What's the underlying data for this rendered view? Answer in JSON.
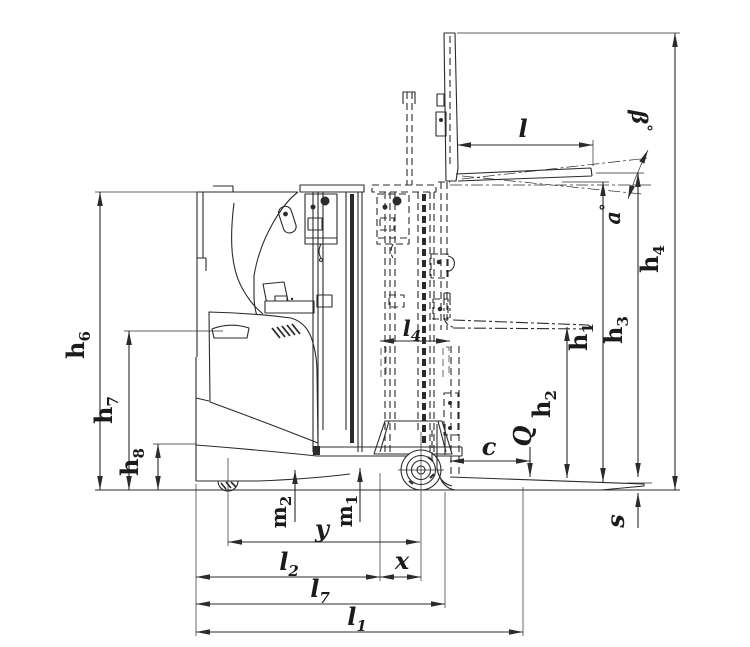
{
  "figure": {
    "kind": "technical dimensional drawing",
    "subject": "reach truck side view with mast retracted, mast reached out and forks shown lowered, at free lift and fully raised"
  },
  "colors": {
    "background": "#ffffff",
    "line": "#2b2b2b",
    "text": "#1b1b1b"
  },
  "labels": {
    "fork_length": {
      "base": "l"
    },
    "tilt_beta": {
      "base": "β",
      "deg": "°"
    },
    "tilt_alpha": {
      "base": "a",
      "deg": "°"
    },
    "h1": {
      "base": "h",
      "sub": "1"
    },
    "h2": {
      "base": "h",
      "sub": "2"
    },
    "h3": {
      "base": "h",
      "sub": "3"
    },
    "h4": {
      "base": "h",
      "sub": "4"
    },
    "h6": {
      "base": "h",
      "sub": "6"
    },
    "h7": {
      "base": "h",
      "sub": "7"
    },
    "h8": {
      "base": "h",
      "sub": "8"
    },
    "l4": {
      "base": "l",
      "sub": "4"
    },
    "load_q": {
      "base": "Q"
    },
    "load_center_c": {
      "base": "c"
    },
    "fork_thickness_s": {
      "base": "s"
    },
    "m1": {
      "base": "m",
      "sub": "1"
    },
    "m2": {
      "base": "m",
      "sub": "2"
    },
    "wheelbase_y": {
      "base": "y"
    },
    "l2": {
      "base": "l",
      "sub": "2"
    },
    "load_distance_x": {
      "base": "x"
    },
    "l7": {
      "base": "l",
      "sub": "7"
    },
    "l1": {
      "base": "l",
      "sub": "1"
    }
  }
}
